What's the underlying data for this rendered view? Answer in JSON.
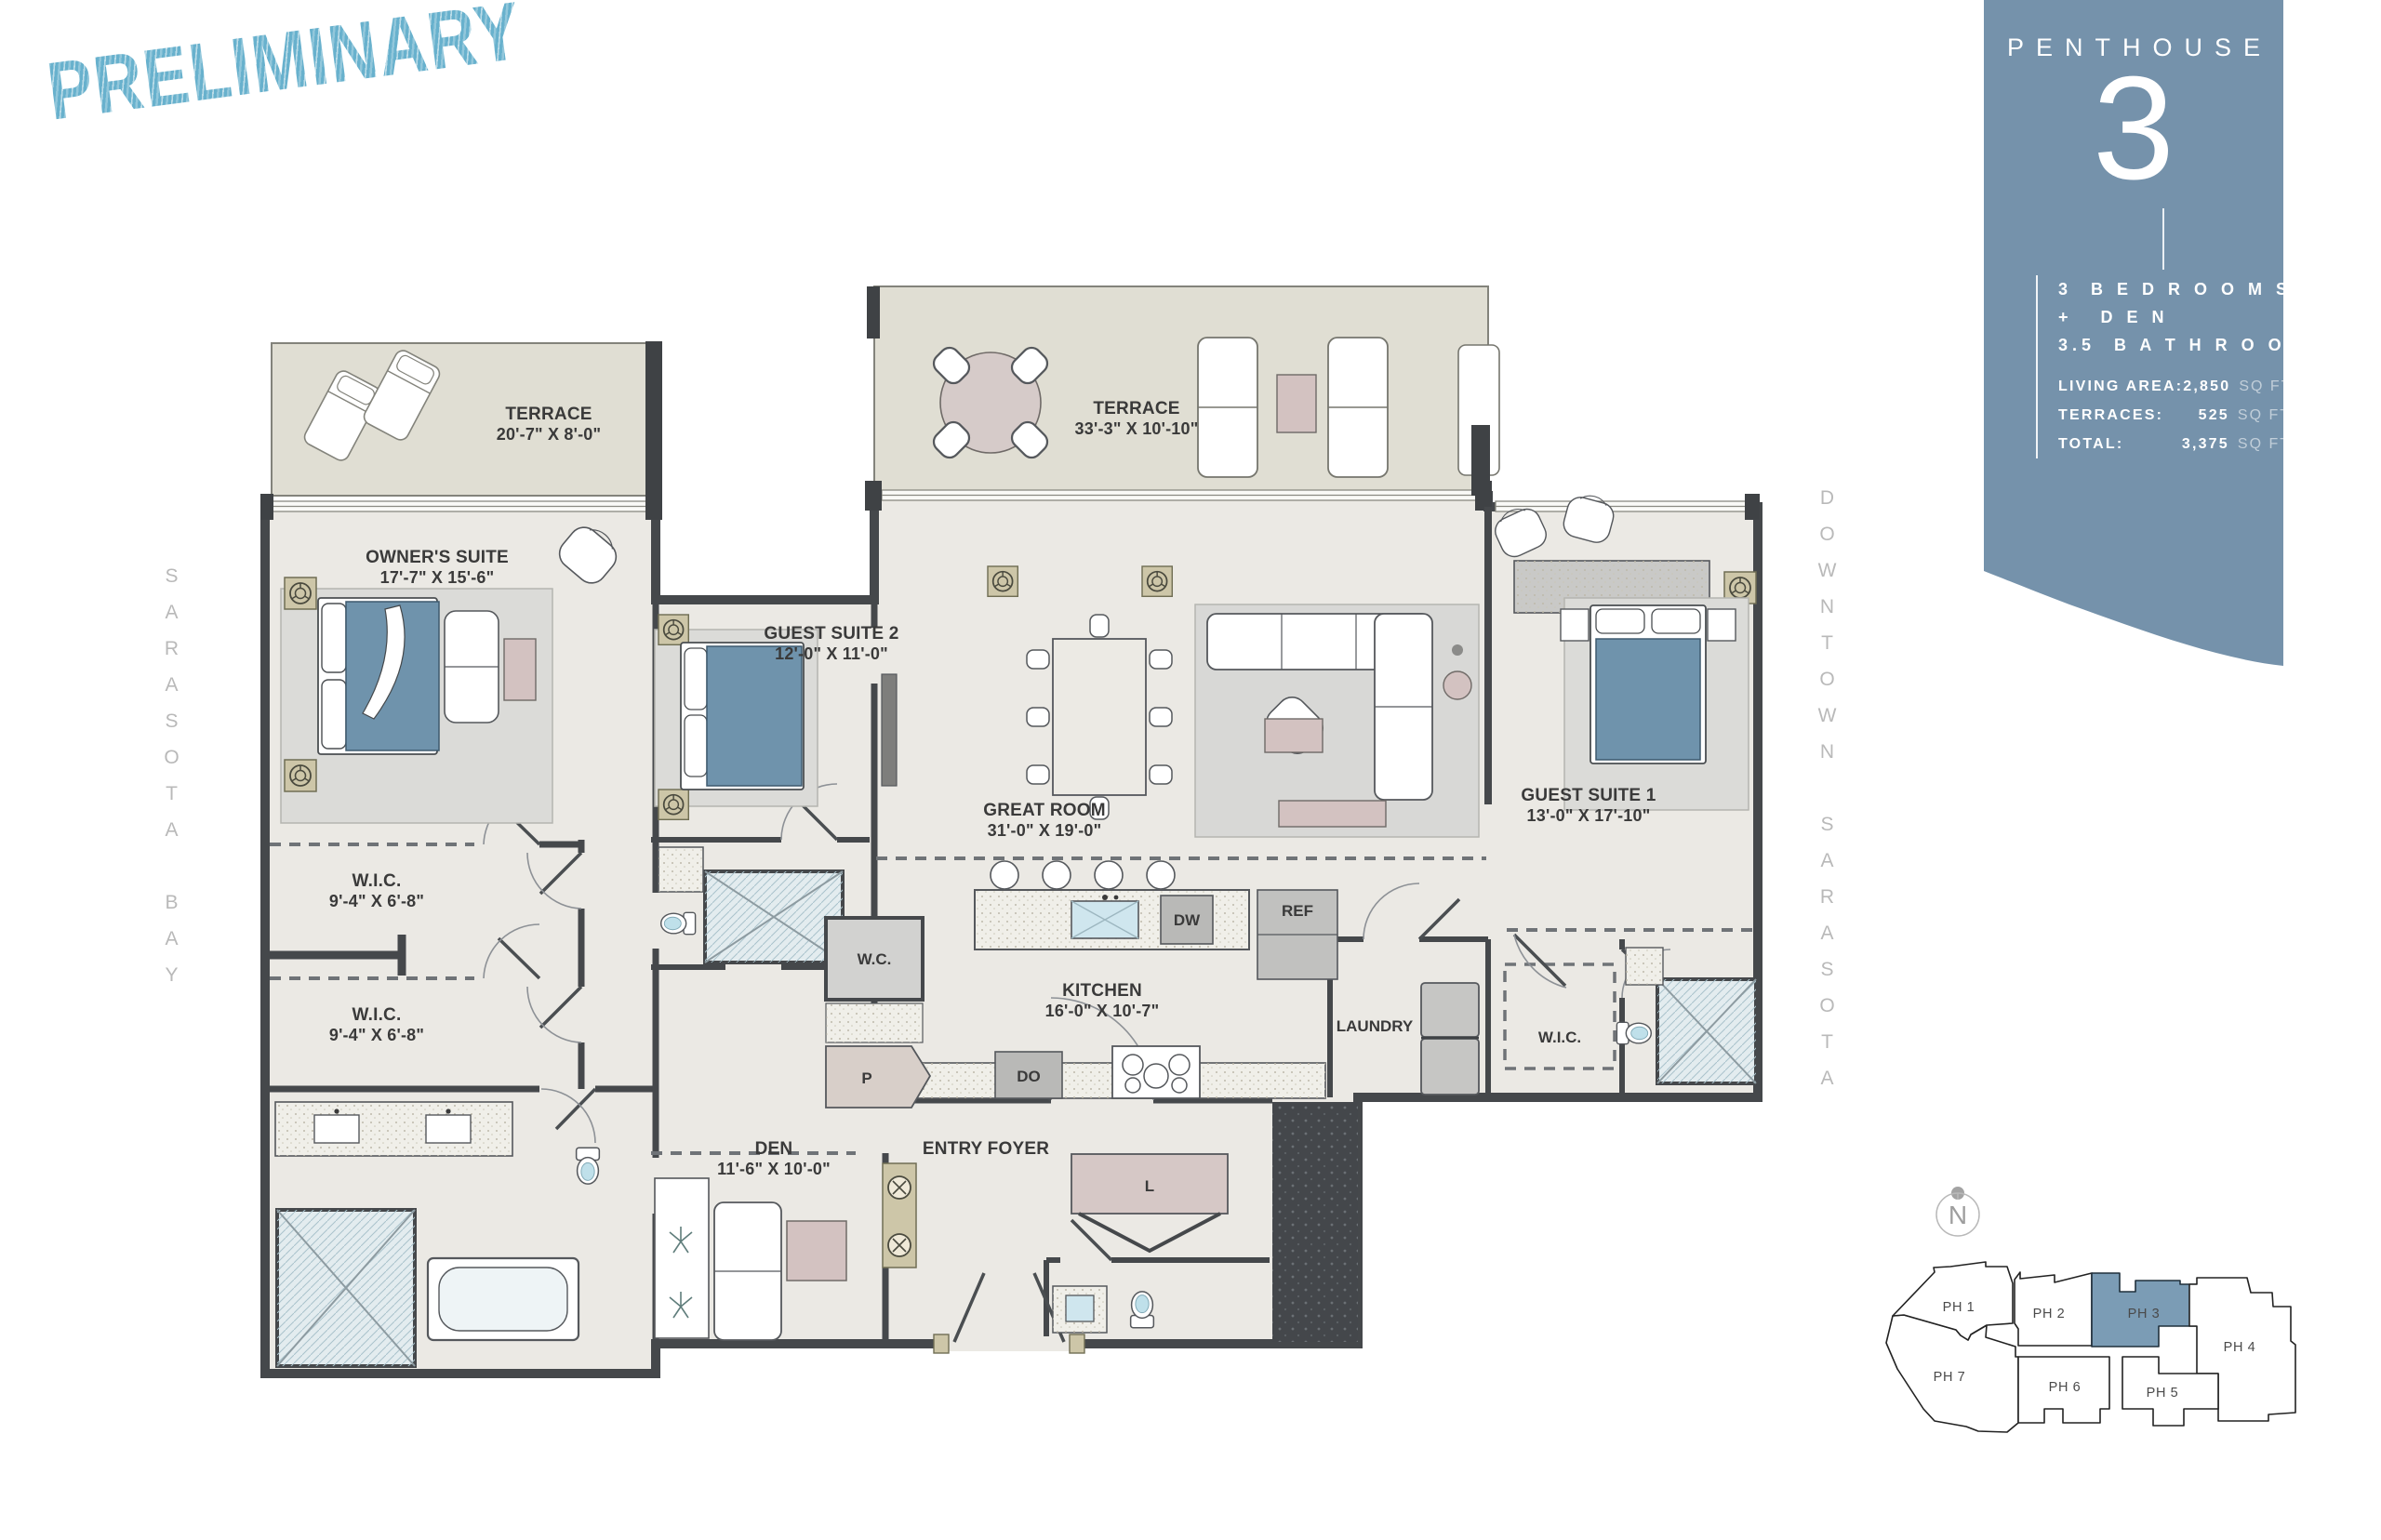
{
  "stamp": {
    "text": "PRELIMINARY",
    "color": "#68b1cd"
  },
  "panel": {
    "kicker": "PENTHOUSE",
    "number": "3",
    "features": [
      "3  B E D R O O M S",
      "+   D E N",
      "3.5  B A T H R O O M S"
    ],
    "stats": [
      {
        "label": "LIVING AREA:",
        "value": "2,850",
        "unit": "SQ FT"
      },
      {
        "label": "TERRACES:",
        "value": "525",
        "unit": "SQ FT"
      },
      {
        "label": "TOTAL:",
        "value": "3,375",
        "unit": "SQ FT"
      }
    ],
    "bg": "#7592ab"
  },
  "context": {
    "left": "SARASOTA BAY",
    "right": "DOWNTOWN SARASOTA"
  },
  "rooms": {
    "terrace_left": {
      "name": "TERRACE",
      "dims": "20'-7\" X 8'-0\""
    },
    "terrace_main": {
      "name": "TERRACE",
      "dims": "33'-3\" X 10'-10\""
    },
    "owners_suite": {
      "name": "OWNER'S SUITE",
      "dims": "17'-7\" X 15'-6\""
    },
    "guest_suite_2": {
      "name": "GUEST SUITE 2",
      "dims": "12'-0\" X 11'-0\""
    },
    "great_room": {
      "name": "GREAT ROOM",
      "dims": "31'-0\" X 19'-0\""
    },
    "guest_suite_1": {
      "name": "GUEST SUITE 1",
      "dims": "13'-0\" X 17'-10\""
    },
    "wic_upper": {
      "name": "W.I.C.",
      "dims": "9'-4\" X 6'-8\""
    },
    "wic_lower": {
      "name": "W.I.C.",
      "dims": "9'-4\" X 6'-8\""
    },
    "kitchen": {
      "name": "KITCHEN",
      "dims": "16'-0\" X 10'-7\""
    },
    "den": {
      "name": "DEN",
      "dims": "11'-6\" X 10'-0\""
    },
    "entry_foyer": {
      "name": "ENTRY FOYER"
    },
    "laundry": {
      "name": "LAUNDRY"
    },
    "wic_right": {
      "name": "W.I.C."
    }
  },
  "fixtures": {
    "wc": "W.C.",
    "pantry": "P",
    "ref": "REF",
    "dw": "DW",
    "do": "DO",
    "linen": "L"
  },
  "keyplan": {
    "compass": "N",
    "highlighted": "PH 3",
    "highlight_color": "#7b9cb5",
    "units": [
      {
        "label": "PH 1"
      },
      {
        "label": "PH 2"
      },
      {
        "label": "PH 3"
      },
      {
        "label": "PH 4"
      },
      {
        "label": "PH 5"
      },
      {
        "label": "PH 6"
      },
      {
        "label": "PH 7"
      }
    ]
  }
}
